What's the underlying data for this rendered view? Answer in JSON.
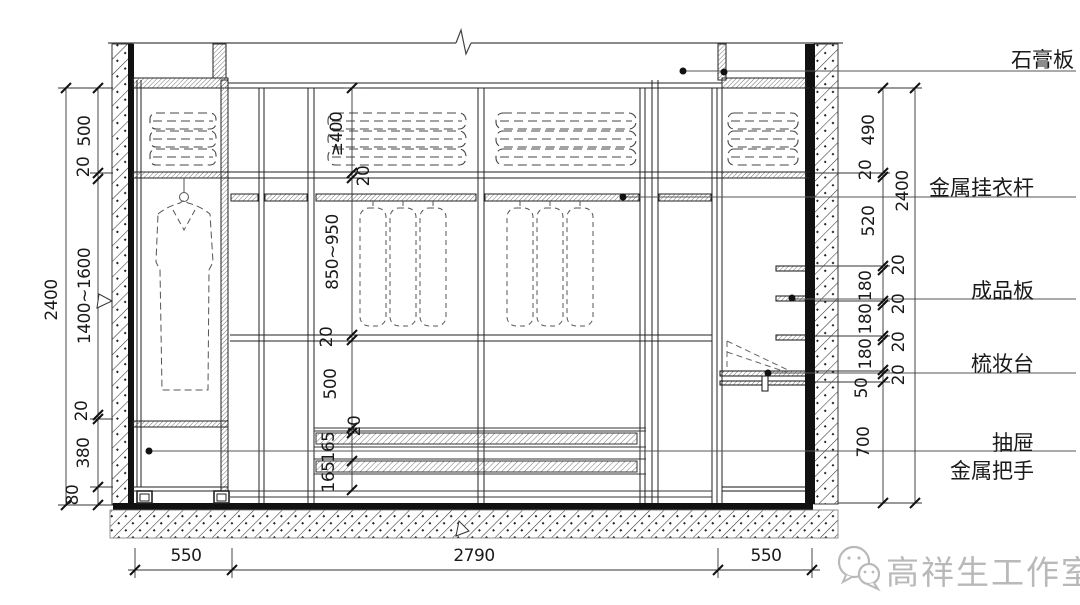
{
  "colors": {
    "line": "#1a1a1a",
    "dim_text": "#1a1a1a",
    "watermark": "#b9b9b9",
    "background": "#ffffff"
  },
  "dims": {
    "left_overall": "2400",
    "left_chain": [
      "500",
      "20",
      "1400~1600",
      "20",
      "380",
      "80"
    ],
    "interior_chain": [
      "≥400",
      "20",
      "850~950",
      "20",
      "500",
      "20",
      "165",
      "165"
    ],
    "right_chain": [
      "490",
      "20",
      "520",
      "20",
      "180",
      "20",
      "180",
      "20",
      "180",
      "20",
      "50",
      "700"
    ],
    "right_overall": "2400",
    "bottom": [
      "550",
      "2790",
      "550"
    ]
  },
  "callouts": {
    "gypsum_board": "石膏板",
    "hanging_rod": "金属挂衣杆",
    "finished_board": "成品板",
    "dressing_table": "梳妆台",
    "drawer": "抽屉",
    "metal_handle": "金属把手"
  },
  "watermark": {
    "icon": "wechat-icon",
    "text": "高祥生工作室"
  }
}
